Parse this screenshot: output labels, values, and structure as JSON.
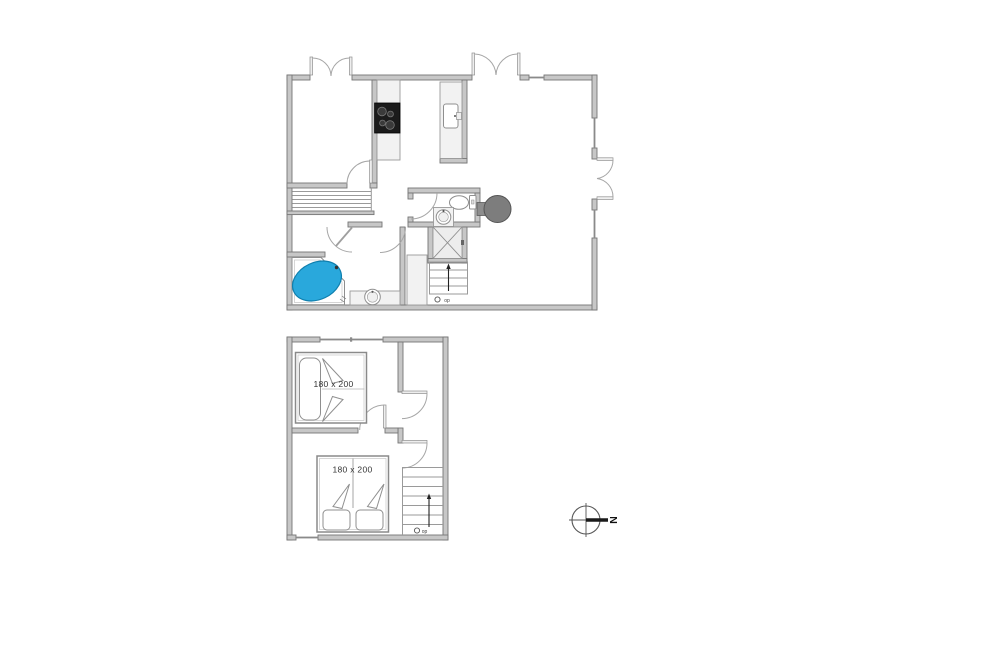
{
  "floorplan": {
    "colors": {
      "wall_fill": "#c7c7c7",
      "wall_edge": "#767676",
      "jacuzzi_blue": "#29a8dc",
      "cooktop_black": "#1b1b1b",
      "stove_gray": "#7d7d7d"
    },
    "ground_floor": {
      "stairs": {
        "direction_label": "op"
      }
    },
    "first_floor": {
      "beds": [
        {
          "size_label": "180 x 200"
        },
        {
          "size_label": "180 x 200"
        }
      ],
      "stairs": {
        "direction_label": "op"
      }
    },
    "compass": {
      "north_label": "N"
    }
  }
}
